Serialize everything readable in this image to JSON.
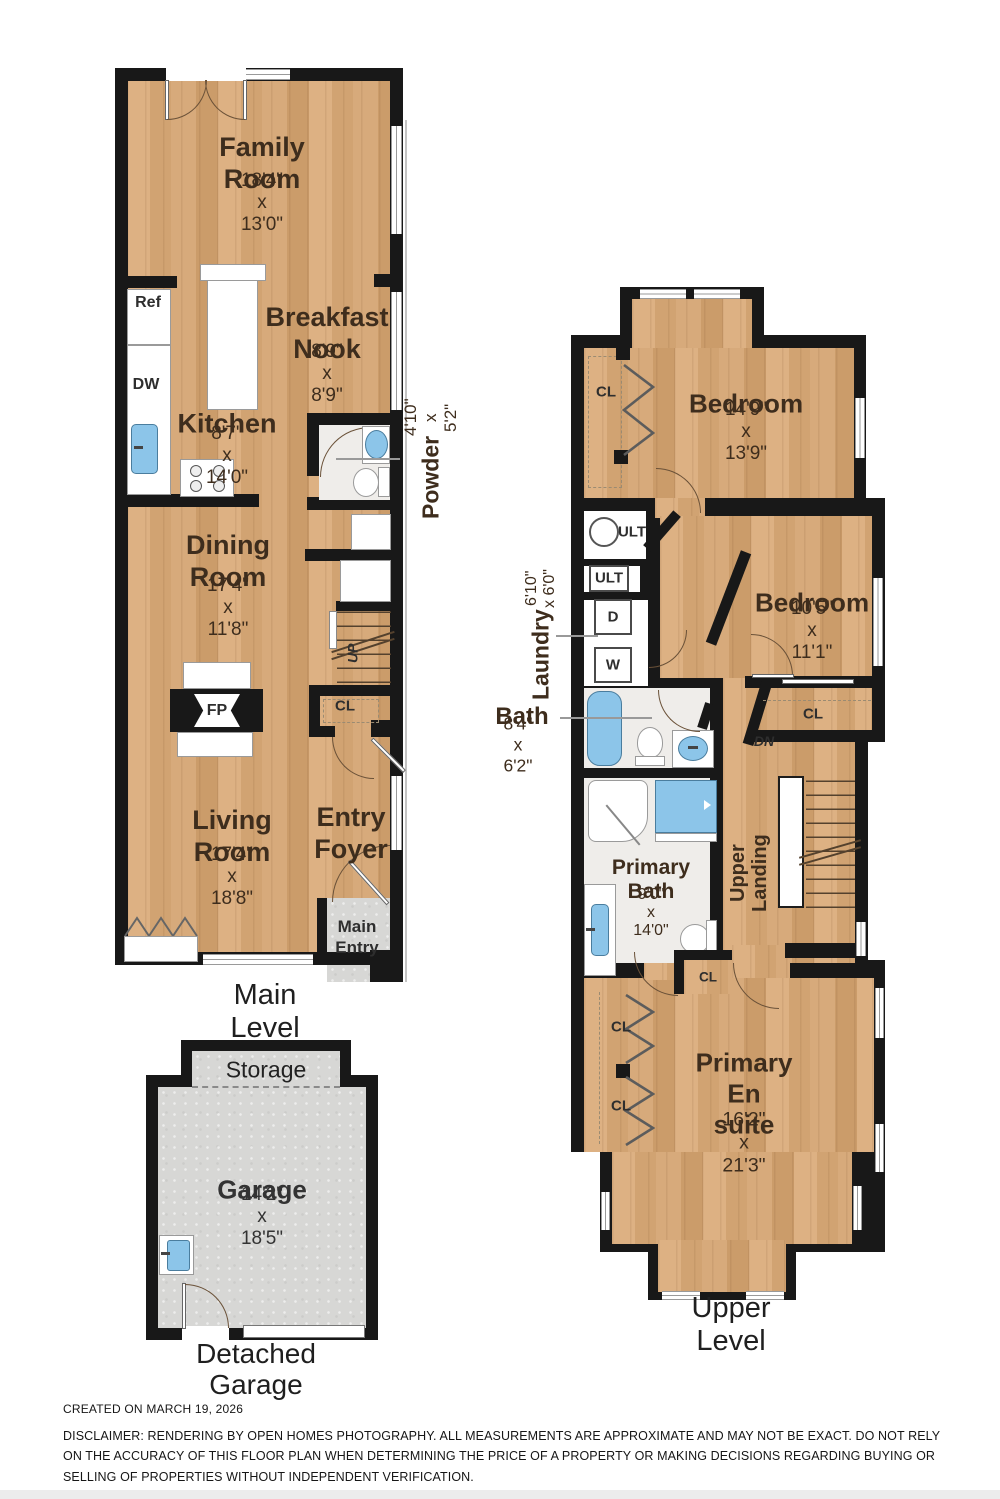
{
  "c": {
    "cl": "CL",
    "ult": "ULT",
    "d": "D",
    "w": "W",
    "up": "UP",
    "dn": "DN",
    "fp": "FP",
    "ref": "Ref",
    "dw": "DW"
  },
  "m": {
    "title": "Main Level",
    "family_name": "Family\nRoom",
    "family_dims": "18'4\" x 13'0\"",
    "breakfast_name": "Breakfast\nNook",
    "breakfast_dims": "8'9\" x 8'9\"",
    "kitchen_name": "Kitchen",
    "kitchen_dims": "8'7\" x 14'0\"",
    "powder_name": "Powder",
    "powder_dims": "4'10\" x 5'2\"",
    "dining_name": "Dining\nRoom",
    "dining_dims": "17'4\" x 11'8\"",
    "living_name": "Living\nRoom",
    "living_dims": "17'4\" x 18'8\"",
    "foyer_name": "Entry\nFoyer",
    "main_entry": "Main\nEntry"
  },
  "g": {
    "storage": "Storage",
    "garage_name": "Garage",
    "garage_dims": "14'2\" x 18'5\"",
    "title": "Detached\nGarage"
  },
  "u": {
    "title": "Upper Level",
    "bedroom1_name": "Bedroom",
    "bedroom1_dims": "14'9\" x 13'9\"",
    "bedroom2_name": "Bedroom",
    "bedroom2_dims": "10'5\" x 11'1\"",
    "laundry_name": "Laundry",
    "laundry_dims": "6'10\" x 6'0\"",
    "bath_name": "Bath",
    "bath_dims": "8'4\" x 6'2\"",
    "primary_bath_name": "Primary\nBath",
    "primary_bath_dims": "9'0\" x 14'0\"",
    "ensuite_name": "Primary\nEn suite",
    "ensuite_dims": "16'2\" x 21'3\"",
    "landing": "Upper\nLanding"
  },
  "f": {
    "created": "CREATED ON MARCH 19, 2026",
    "disclaimer": "DISCLAIMER: RENDERING BY OPEN HOMES PHOTOGRAPHY. ALL MEASUREMENTS ARE APPROXIMATE AND MAY NOT BE EXACT. DO NOT RELY ON THE ACCURACY OF THIS FLOOR PLAN WHEN DETERMINING THE PRICE OF A PROPERTY OR MAKING DECISIONS REGARDING BUYING OR SELLING OF PROPERTIES WITHOUT INDEPENDENT VERIFICATION."
  },
  "colors": {
    "wood": "#d5a777",
    "wall": "#181818",
    "fixture_blue": "#8cc5e9",
    "tile": "#d8d8d6",
    "label_text": "#3e2d1d"
  }
}
